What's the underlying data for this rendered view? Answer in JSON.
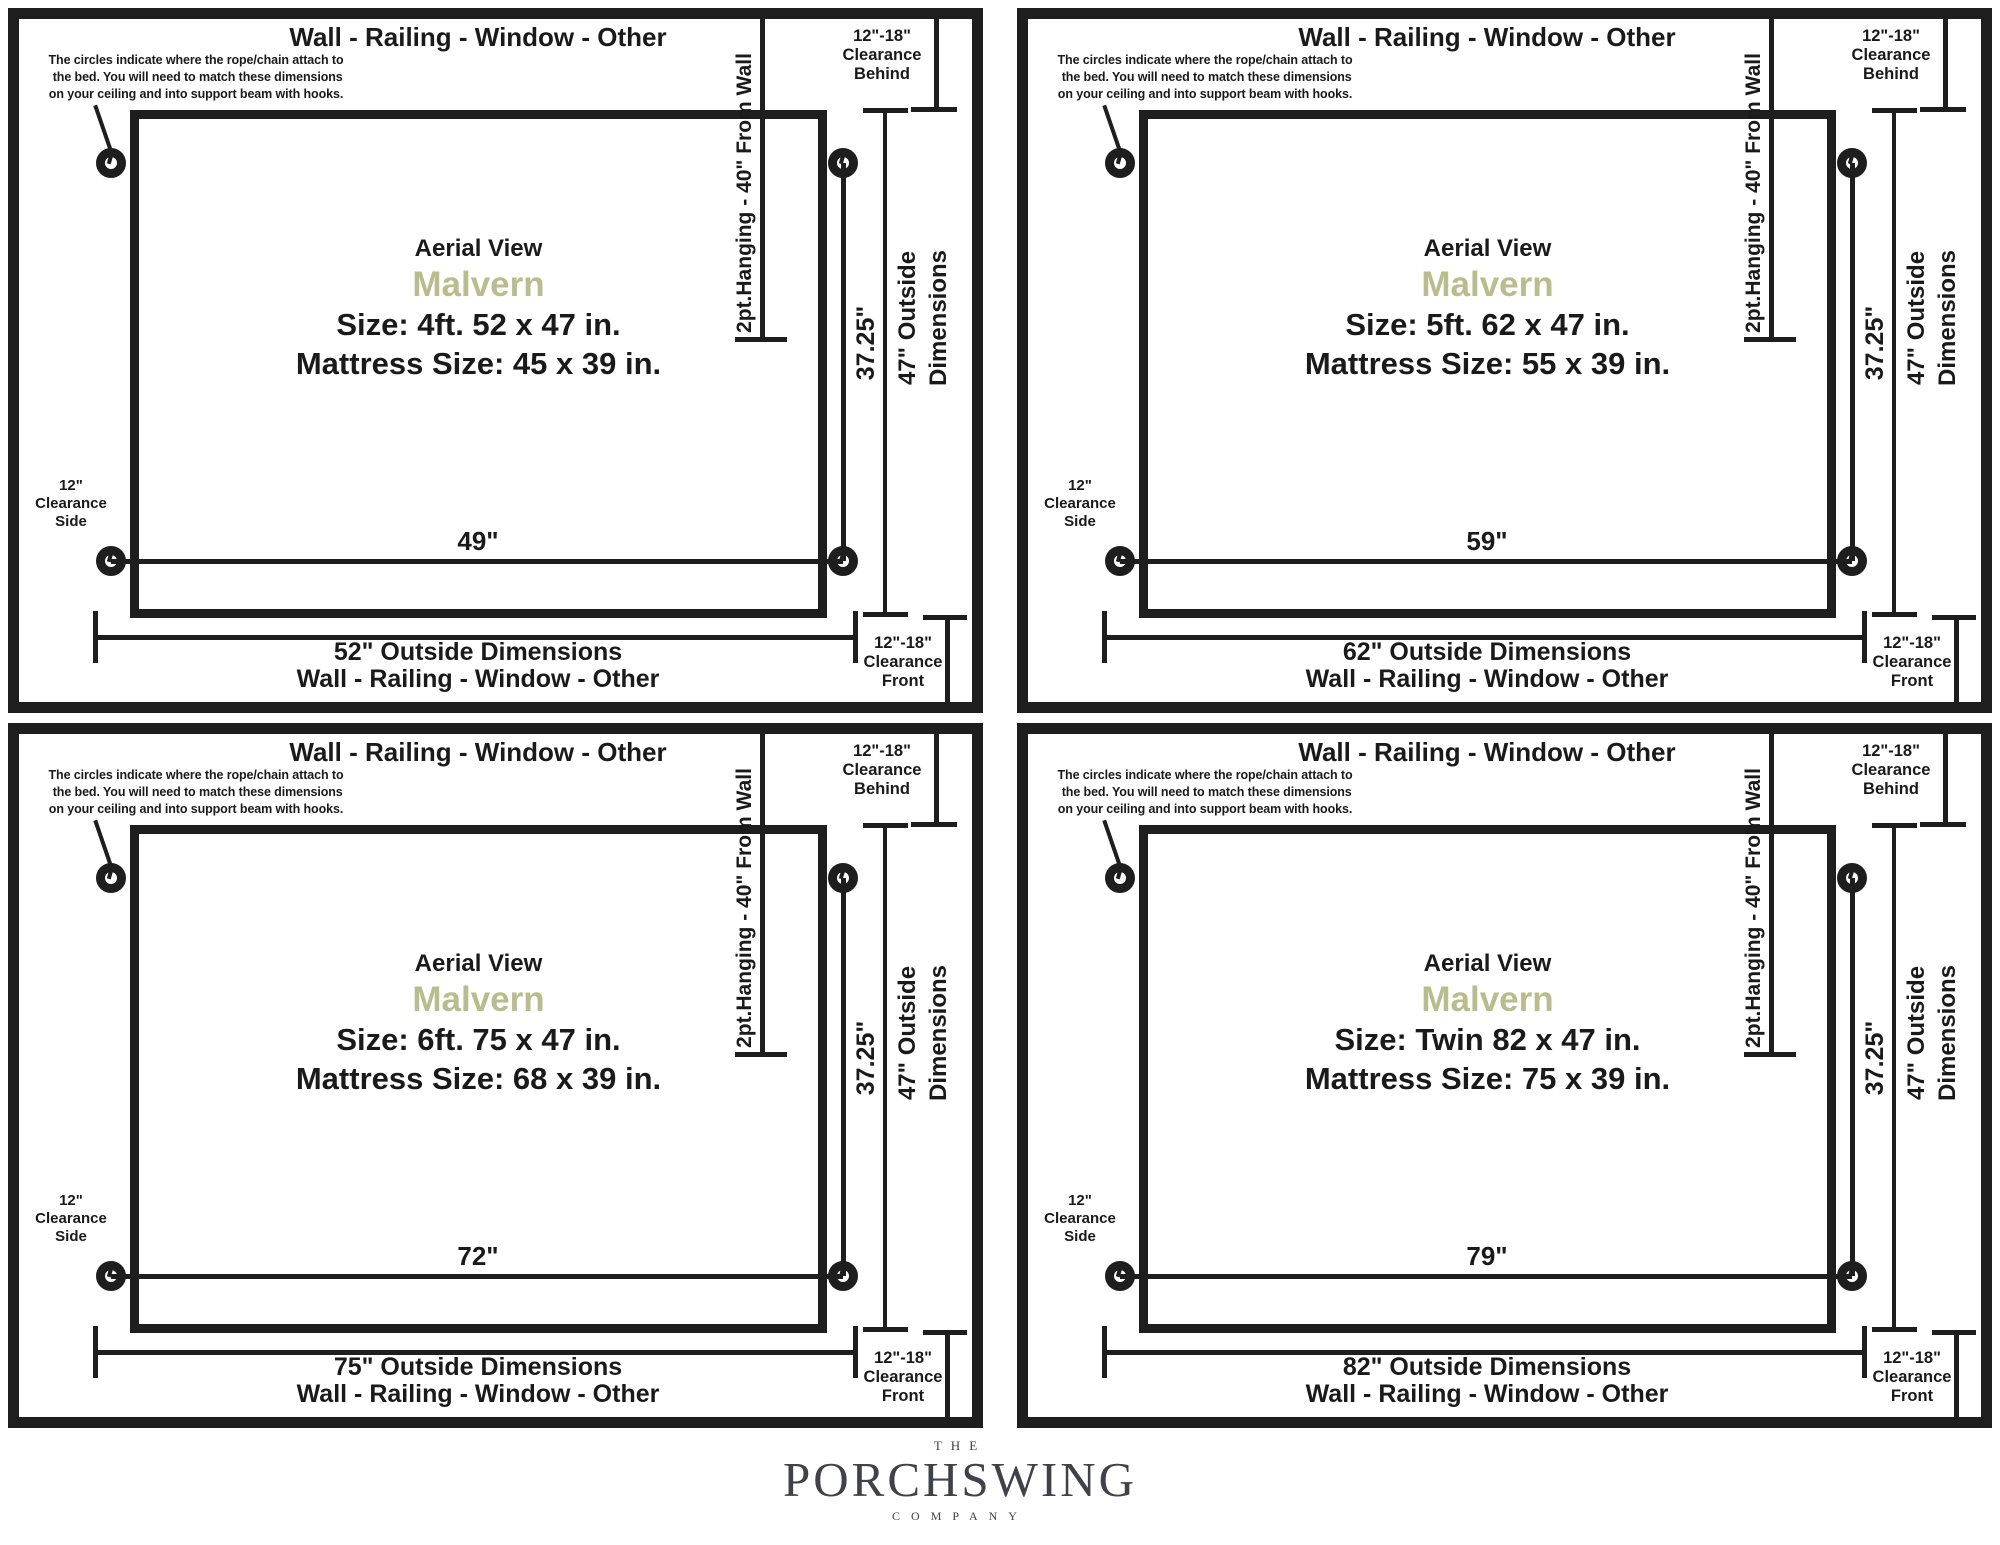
{
  "shared": {
    "top_wall_label": "Wall - Railing - Window - Other",
    "note": "The circles indicate where the rope/chain attach to\n the bed. You will need to match these dimensions\non your ceiling and into support beam with hooks.",
    "aerial_label": "Aerial View",
    "product_name": "Malvern",
    "hanging_line_label": "2pt.Hanging - 40\" From Wall",
    "hanging_depth_label": "37.25\"",
    "outside_depth_label": "47\" Outside\nDimensions",
    "clearance_behind_label": "12\"-18\"\nClearance\nBehind",
    "clearance_front_label": "12\"-18\"\nClearance\nFront",
    "clearance_side_label": "12\"\nClearance\nSide",
    "bottom_wall_label": "Wall - Railing - Window - Other",
    "colors": {
      "product_accent": "#b9bd8e",
      "diagram_line": "#1e1e1e",
      "logo_text": "#41414b"
    }
  },
  "panels": [
    {
      "name": "4ft",
      "size_label": "Size: 4ft. 52 x 47 in.",
      "mattress_label": "Mattress Size: 45 x 39 in.",
      "hanging_width_label": "49\"",
      "outside_width_label": "52\" Outside Dimensions"
    },
    {
      "name": "5ft",
      "size_label": "Size: 5ft. 62 x 47 in.",
      "mattress_label": "Mattress Size: 55 x 39 in.",
      "hanging_width_label": "59\"",
      "outside_width_label": "62\" Outside Dimensions"
    },
    {
      "name": "6ft",
      "size_label": "Size: 6ft. 75 x 47 in.",
      "mattress_label": "Mattress Size: 68 x 39 in.",
      "hanging_width_label": "72\"",
      "outside_width_label": "75\" Outside Dimensions"
    },
    {
      "name": "twin",
      "size_label": "Size: Twin 82 x 47 in.",
      "mattress_label": "Mattress Size: 75 x 39 in.",
      "hanging_width_label": "79\"",
      "outside_width_label": "82\" Outside Dimensions"
    }
  ],
  "logo": {
    "the": "THE",
    "name": "PORCHSWING",
    "company": "COMPANY"
  }
}
